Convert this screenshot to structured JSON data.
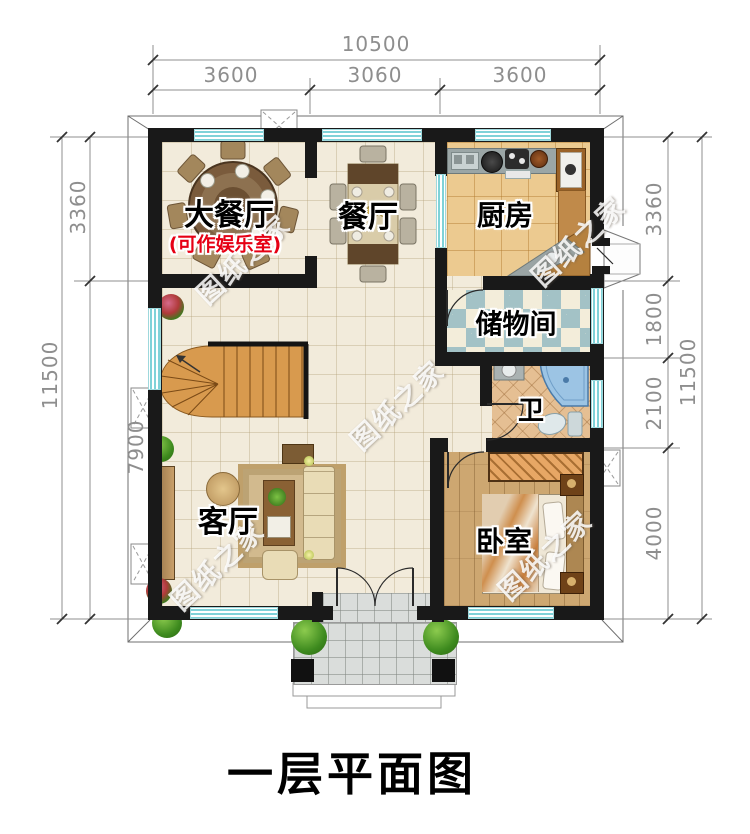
{
  "title": "一层平面图",
  "watermark": "图纸之家",
  "dimensions": {
    "top": {
      "total": "10500",
      "seg1": "3600",
      "seg2": "3060",
      "seg3": "3600"
    },
    "left": {
      "total": "11500",
      "seg1": "3360",
      "seg2": "7900"
    },
    "right": {
      "total": "11500",
      "seg1": "3360",
      "seg2": "1800",
      "seg3": "2100",
      "seg4": "4000"
    }
  },
  "rooms": {
    "dining_large": {
      "name": "大餐厅",
      "note": "(可作娱乐室)"
    },
    "dining": {
      "name": "餐厅"
    },
    "kitchen": {
      "name": "厨房"
    },
    "storage": {
      "name": "储物间"
    },
    "bath": {
      "name": "卫"
    },
    "living": {
      "name": "客厅"
    },
    "bedroom": {
      "name": "卧室"
    }
  },
  "colors": {
    "wall": "#191919",
    "window": "#7fd2d8",
    "kitchen_floor": "#ecca90",
    "bedroom_floor": "#cda771",
    "note_red": "#e60014"
  }
}
